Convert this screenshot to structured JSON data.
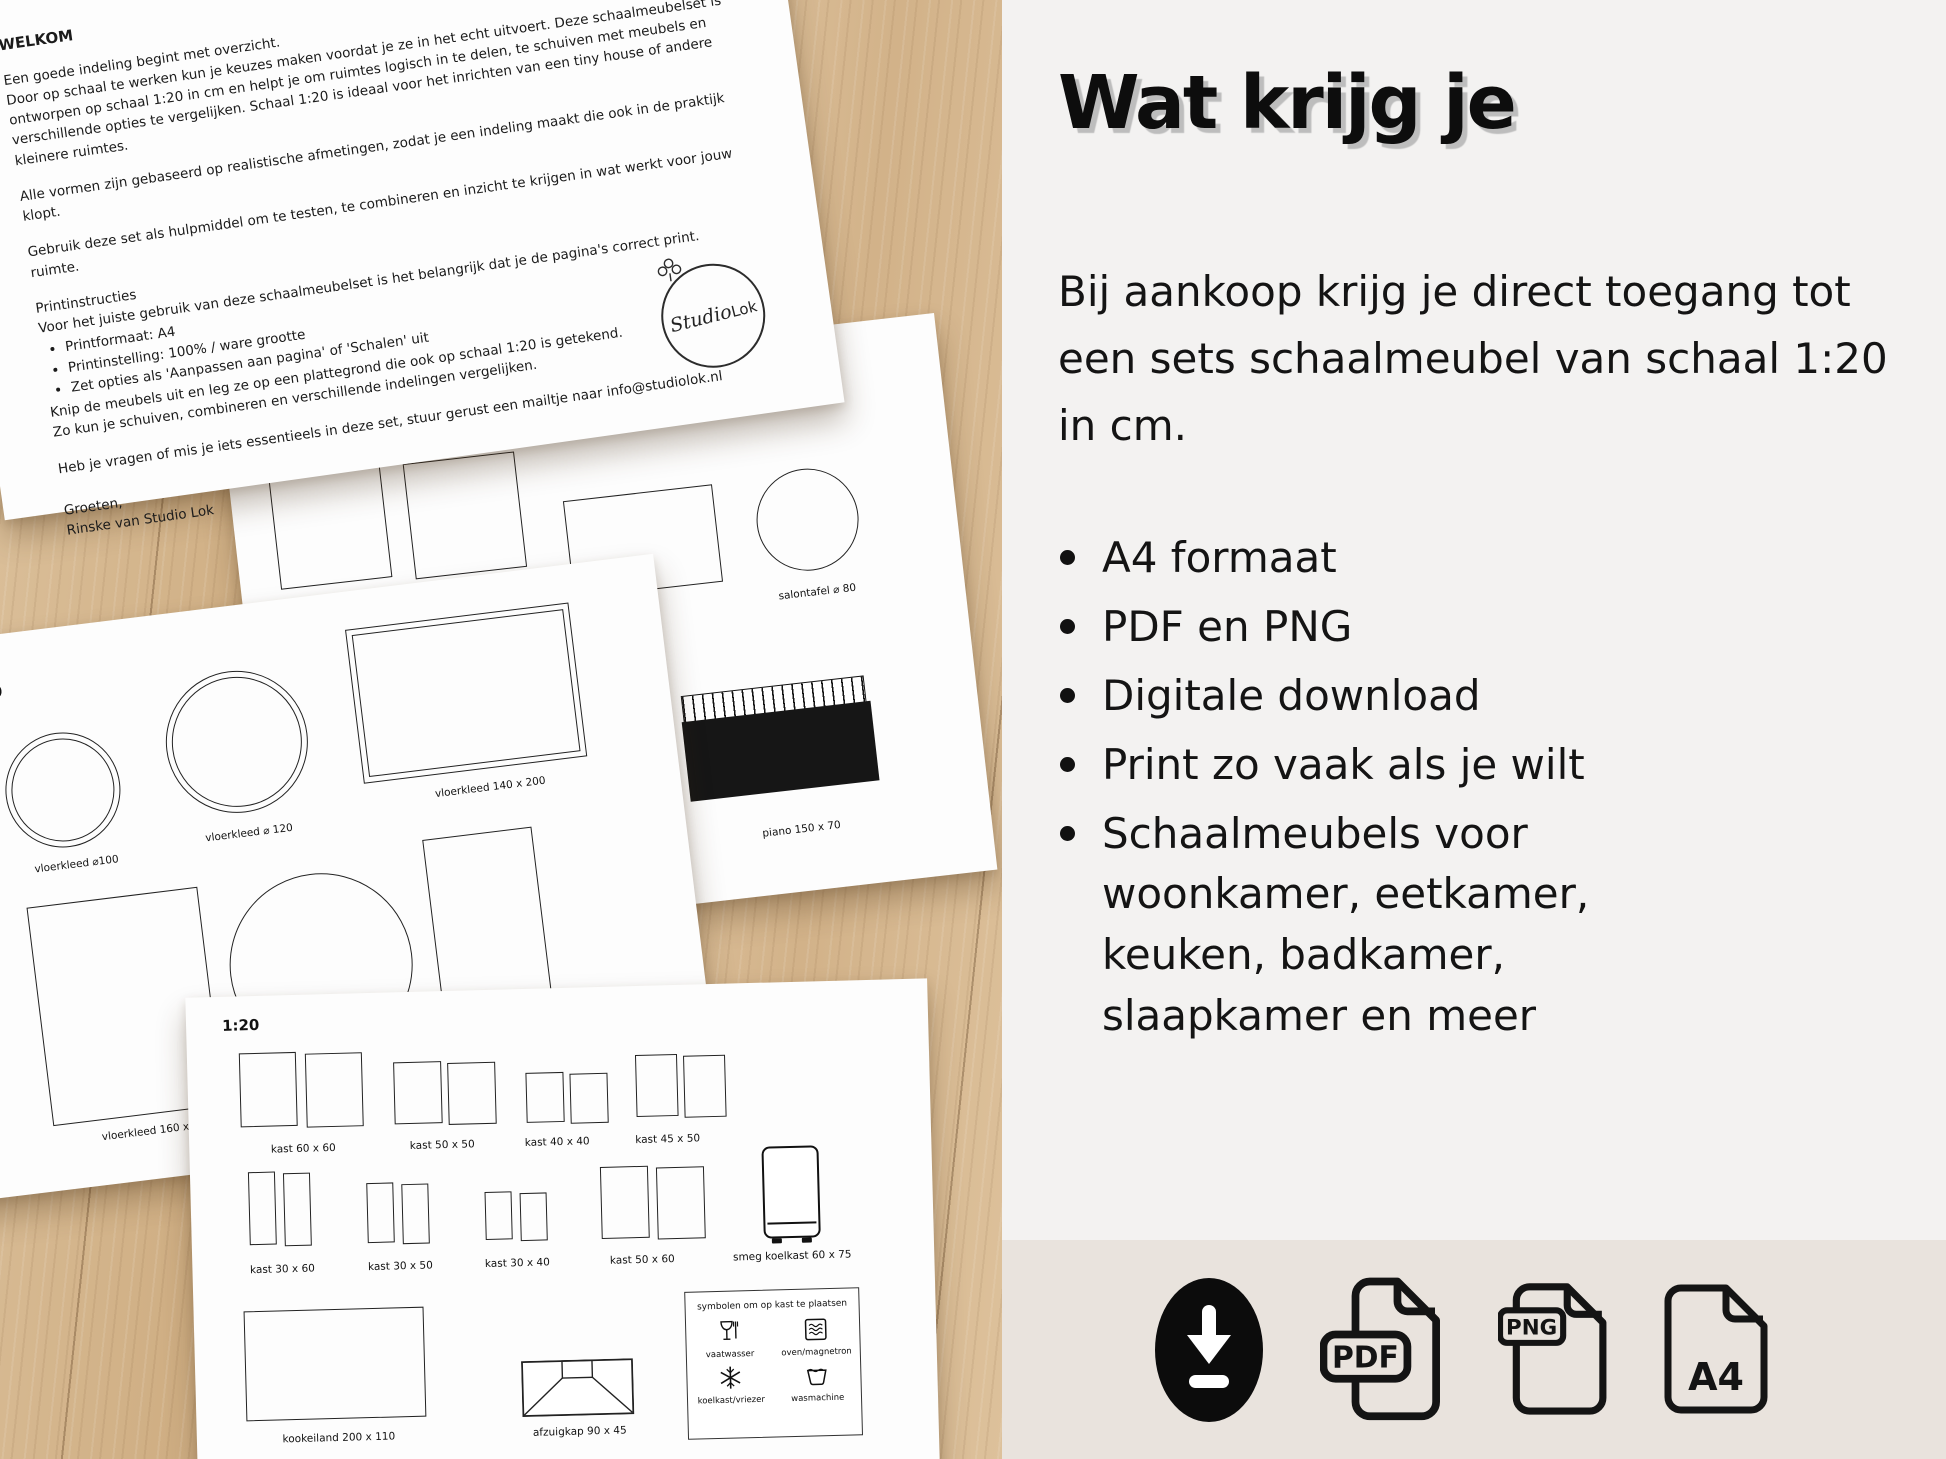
{
  "letter": {
    "title": "WELKOM",
    "para1a": "Een goede indeling begint met overzicht.",
    "para1b": "Door op schaal te werken kun je keuzes maken voordat je ze in het echt uitvoert. Deze schaalmeubelset is ontworpen op schaal 1:20 in cm en helpt je om ruimtes logisch in te delen, te schuiven met meubels en verschillende opties te vergelijken. Schaal 1:20 is ideaal voor het inrichten van een tiny house of andere kleinere ruimtes.",
    "para2": "Alle vormen zijn gebaseerd op realistische afmetingen, zodat je een indeling maakt die ook in de praktijk klopt.",
    "para3": "Gebruik deze set als hulpmiddel om te testen, te combineren en inzicht te krijgen in wat werkt voor jouw ruimte.",
    "print_title": "Printinstructies",
    "print_intro": "Voor het juiste gebruik van deze schaalmeubelset is het belangrijk dat je de pagina's correct print.",
    "print_bullets": [
      "Printformaat: A4",
      "Printinstelling: 100% / ware grootte",
      "Zet opties als 'Aanpassen aan pagina' of 'Schalen' uit"
    ],
    "print_outro1": "Knip de meubels uit en leg ze op een plattegrond die ook op schaal 1:20 is getekend.",
    "print_outro2": "Zo kun je schuiven, combineren en verschillende indelingen vergelijken.",
    "contact": "Heb je vragen of mis je iets essentieels in deze set, stuur gerust een mailtje naar info@studiolok.nl",
    "closing1": "Groeten,",
    "closing2": "Rinske van Studio Lok",
    "logo_script": "Studio",
    "logo_print": "Lok"
  },
  "pages": {
    "scale": "1:20",
    "p2": {
      "salontafel_sq": "salontafel 80 x 80",
      "salontafel_round": "salontafel ⌀ 80",
      "piano": "piano 150 x 70"
    },
    "p3": {
      "r100": "vloerkleed ⌀100",
      "r120": "vloerkleed ⌀ 120",
      "r140": "vloerkleed 140 x 200",
      "r160": "vloerkleed 160 x 130"
    },
    "p4": {
      "k6060": "kast 60 x 60",
      "k5050": "kast 50 x 50",
      "k4040": "kast 40 x 40",
      "k4550": "kast 45 x 50",
      "k3060": "kast 30 x 60",
      "k3050": "kast 30 x 50",
      "k3040": "kast 30 x 40",
      "k5060": "kast 50 x 60",
      "smeg": "smeg koelkast 60 x 75",
      "kookeiland": "kookeiland 200 x 110",
      "afzuigkap": "afzuigkap 90 x 45",
      "symbols": {
        "title": "symbolen om op kast te plaatsen",
        "items": [
          "vaatwasser",
          "oven/magnetron",
          "koelkast/vriezer",
          "wasmachine"
        ]
      }
    }
  },
  "panel": {
    "heading": "Wat krijg je",
    "intro": "Bij aankoop krijg je direct toegang tot een sets schaalmeubel van schaal 1:20 in cm.",
    "bullets": [
      "A4 formaat",
      "PDF en PNG",
      "Digitale download",
      "Print zo vaak als je wilt",
      "Schaalmeubels voor woonkamer, eetkamer, keuken, badkamer, slaapkamer en meer"
    ]
  },
  "strip": {
    "pdf_label": "PDF",
    "png_label": "PNG",
    "a4_label": "A4"
  },
  "colors": {
    "panel_bg": "#f3f2f1",
    "strip_bg": "#e9e3dd",
    "ink": "#111111",
    "wood": "#d5b690"
  }
}
